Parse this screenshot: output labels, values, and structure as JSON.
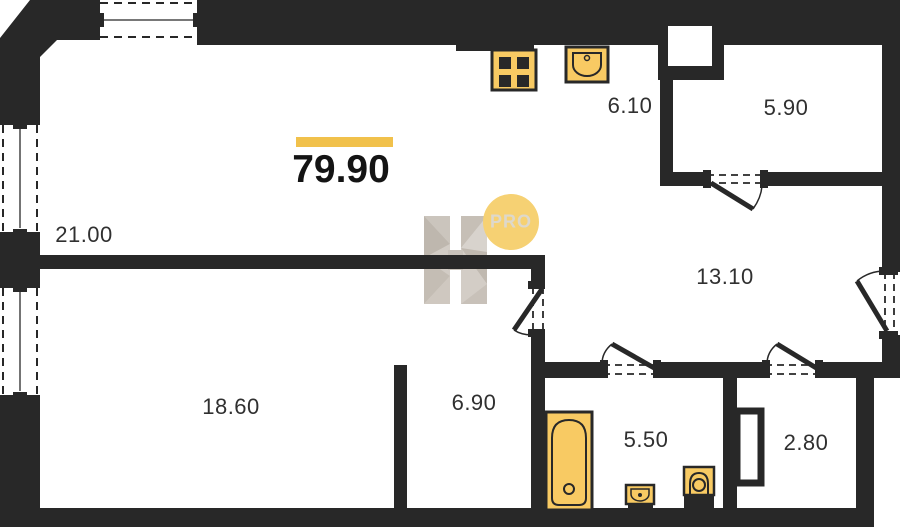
{
  "plan": {
    "total_area": "79.90",
    "watermark_badge": "PRO",
    "rooms": [
      {
        "name": "living-room",
        "area": "21.00"
      },
      {
        "name": "bedroom",
        "area": "18.60"
      },
      {
        "name": "hall",
        "area": "6.90"
      },
      {
        "name": "bathroom",
        "area": "5.50"
      },
      {
        "name": "storage",
        "area": "2.80"
      },
      {
        "name": "corridor",
        "area": "13.10"
      },
      {
        "name": "kitchen",
        "area": "6.10"
      },
      {
        "name": "balcony",
        "area": "5.90"
      }
    ]
  },
  "colors": {
    "wall": "#282828",
    "fixture_fill": "#f8ca63",
    "accent": "#f1c14b",
    "badge": "#f6d173",
    "label": "#303030"
  }
}
